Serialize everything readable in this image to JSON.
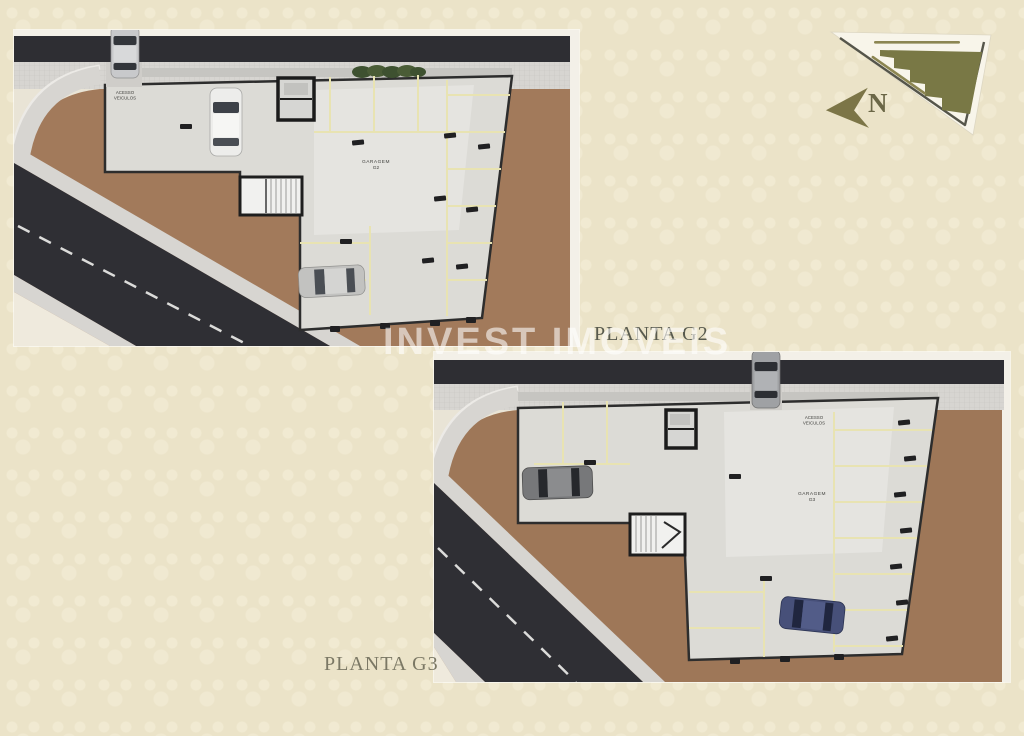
{
  "watermark": {
    "text": "INVEST IMOVEIS",
    "color": "rgba(255,255,255,0.58)"
  },
  "plan_labels": {
    "g2": "PLANTA G2",
    "g3": "PLANTA G3"
  },
  "plans": {
    "g2": {
      "access_line1": "ACESSO",
      "access_line2": "VEICULOS",
      "garage_line1": "GARAGEM",
      "garage_line2": "G2"
    },
    "g3": {
      "access_line1": "ACESSO",
      "access_line2": "VEICULOS",
      "garage_line1": "GARAGEM",
      "garage_line2": "G3"
    }
  },
  "site_map": {
    "north_label": "N"
  },
  "colors": {
    "page_background": "#ebe3c8",
    "road": "#2e2e33",
    "sidewalk": "#d7d5d1",
    "ground": "#a27a5b",
    "slab": "#dcdbd6",
    "parking_line": "#e8e3b2",
    "building_footprint": "#797845",
    "north_arrow": "#7c7547",
    "label_g2": "#585a4e",
    "label_g3": "#7b7865"
  }
}
